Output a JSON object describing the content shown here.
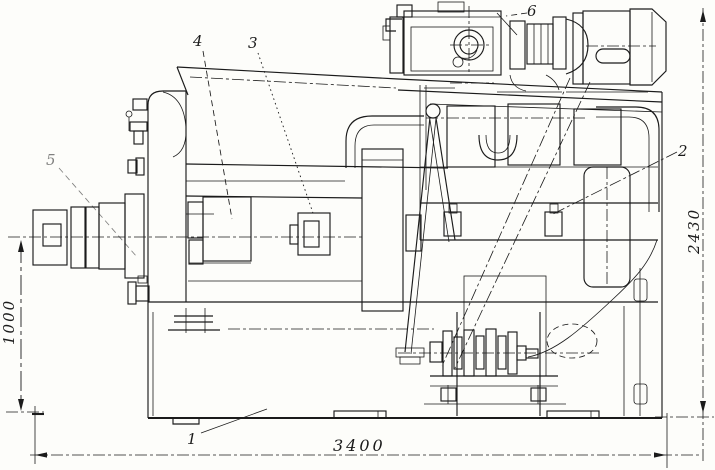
{
  "colors": {
    "ink": "#1b1b1b",
    "paper": "#fdfdfa"
  },
  "drawing": {
    "type": "scanned technical line drawing, machine side elevation with overall dimensions",
    "dimensions": {
      "spindle_height": "1000",
      "overall_length": "3400",
      "overall_height": "2430"
    },
    "callouts": [
      {
        "label": "1"
      },
      {
        "label": "2"
      },
      {
        "label": "3"
      },
      {
        "label": "4"
      },
      {
        "label": "5"
      },
      {
        "label": "6"
      }
    ]
  }
}
